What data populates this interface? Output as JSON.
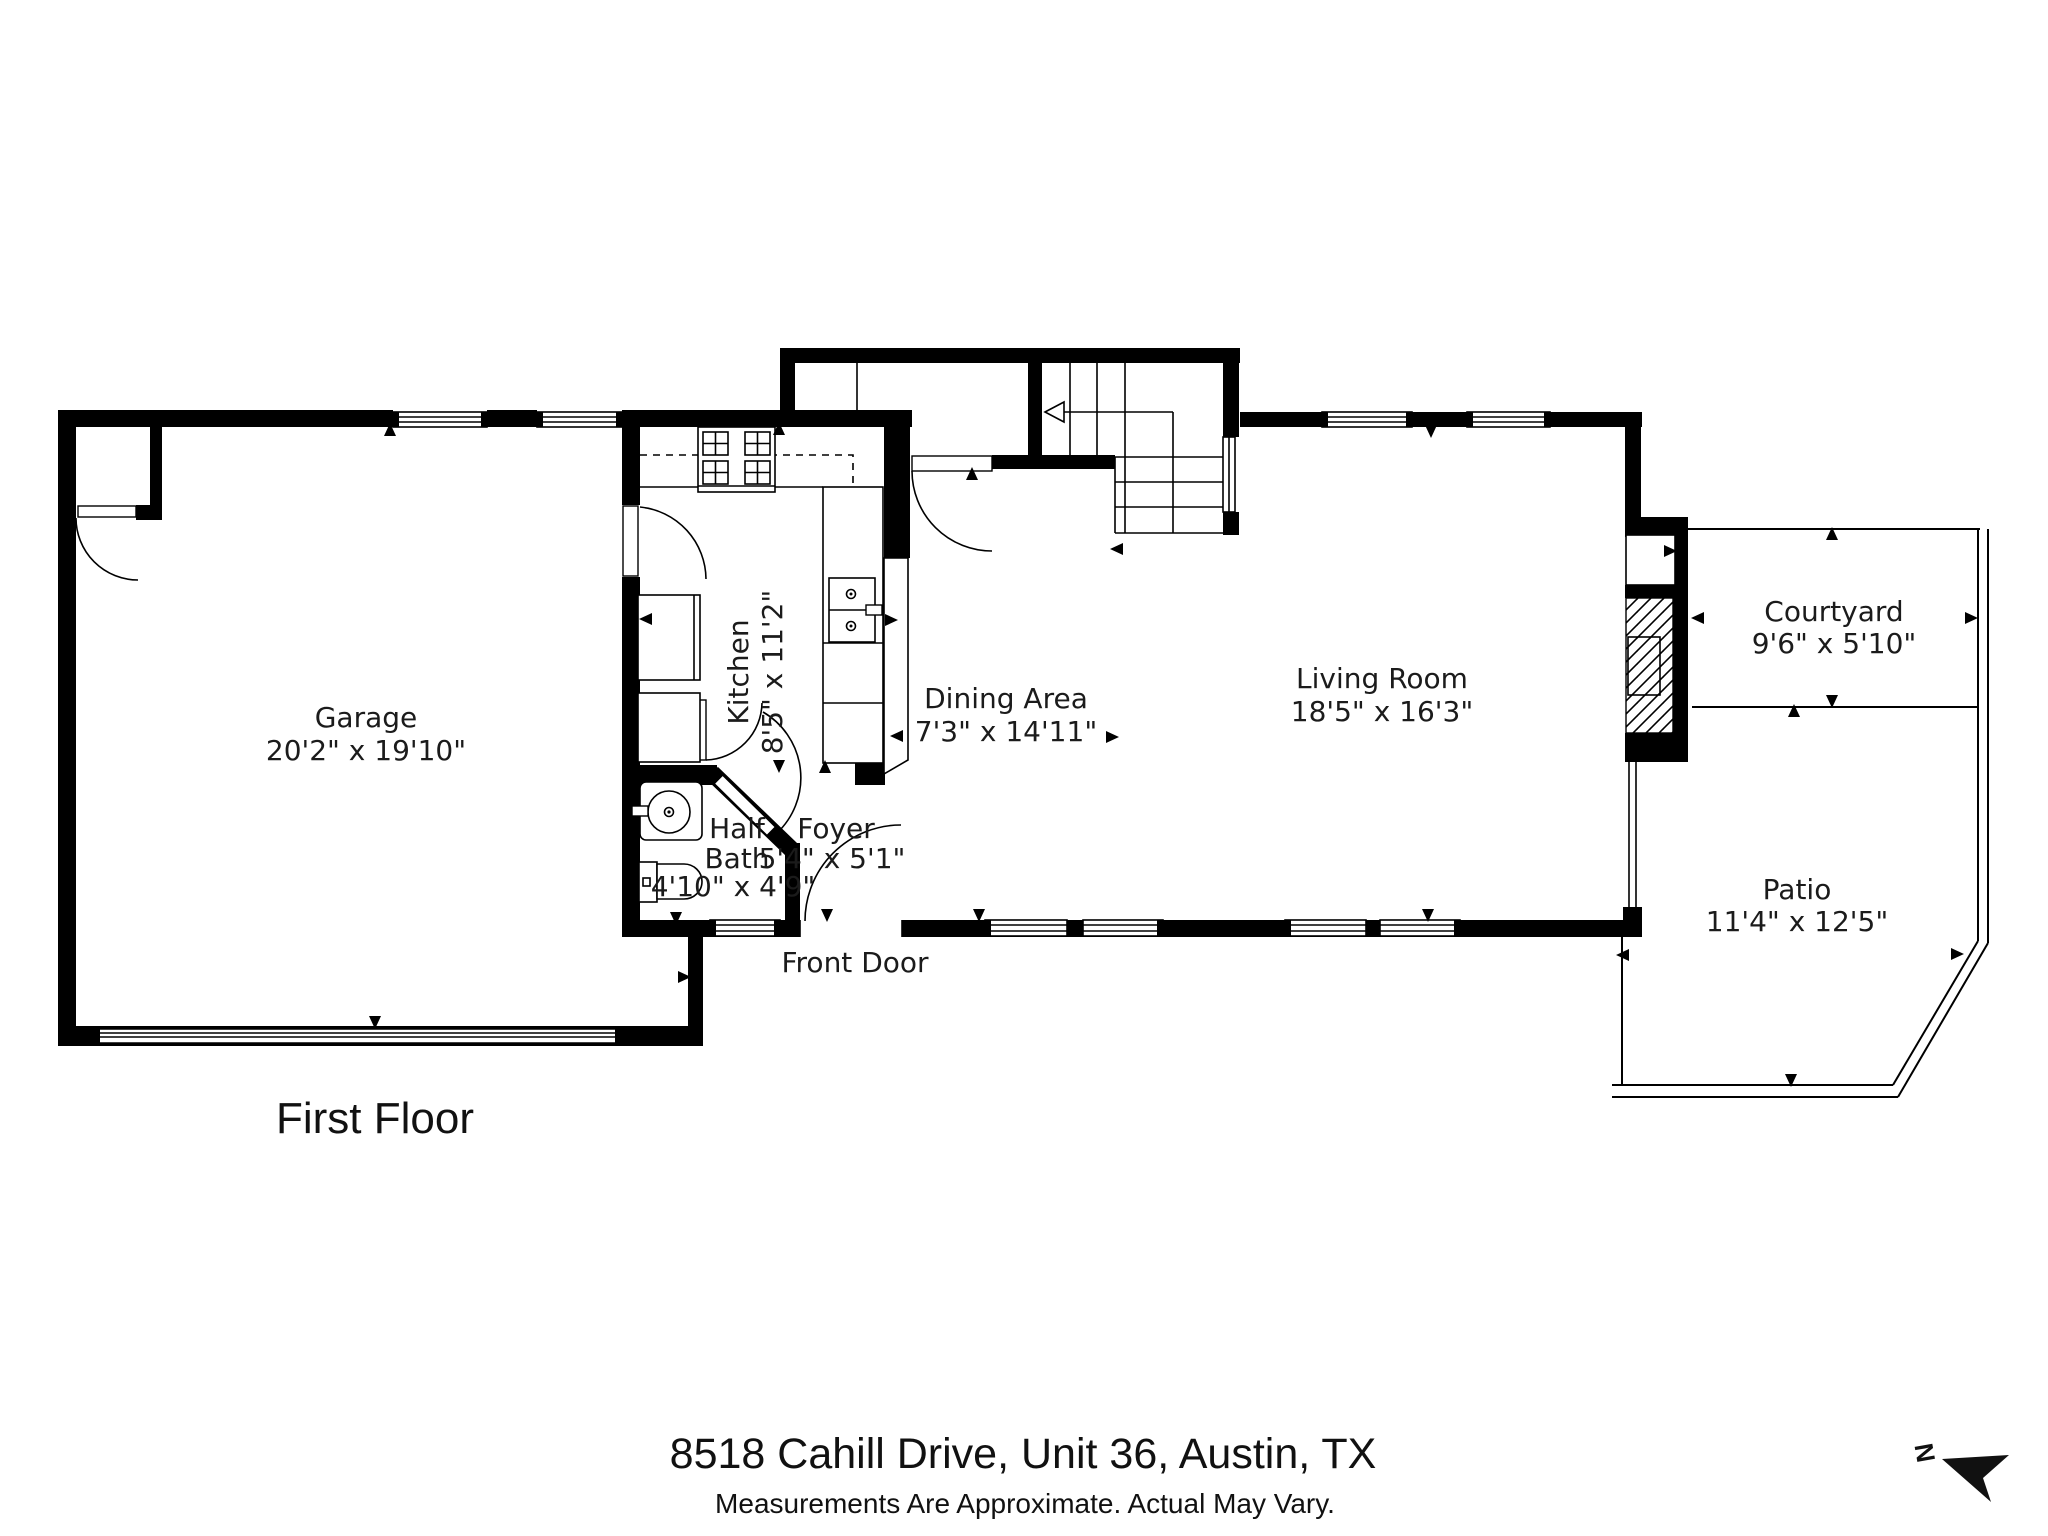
{
  "floor_title": "First Floor",
  "address": "8518 Cahill Drive, Unit 36, Austin, TX",
  "disclaimer": "Measurements Are Approximate. Actual May Vary.",
  "north_label": "N",
  "rooms": {
    "garage": {
      "name": "Garage",
      "dims": "20'2\" x 19'10\""
    },
    "kitchen": {
      "name": "Kitchen",
      "dims": "8'5\" x 11'2\""
    },
    "dining": {
      "name": "Dining Area",
      "dims": "7'3\" x 14'11\""
    },
    "living": {
      "name": "Living Room",
      "dims": "18'5\" x 16'3\""
    },
    "courtyard": {
      "name": "Courtyard",
      "dims": "9'6\" x 5'10\""
    },
    "patio": {
      "name": "Patio",
      "dims": "11'4\" x 12'5\""
    },
    "half_bath": {
      "name_line1": "Half",
      "name_line2": "Bath",
      "dims": "4'10\" x 4'9\""
    },
    "foyer": {
      "name": "Foyer",
      "dims": "5'4\" x 5'1\""
    }
  },
  "labels": {
    "front_door": "Front Door"
  },
  "colors": {
    "walls": "#000000",
    "background": "#ffffff",
    "text": "#1b1b1b"
  }
}
